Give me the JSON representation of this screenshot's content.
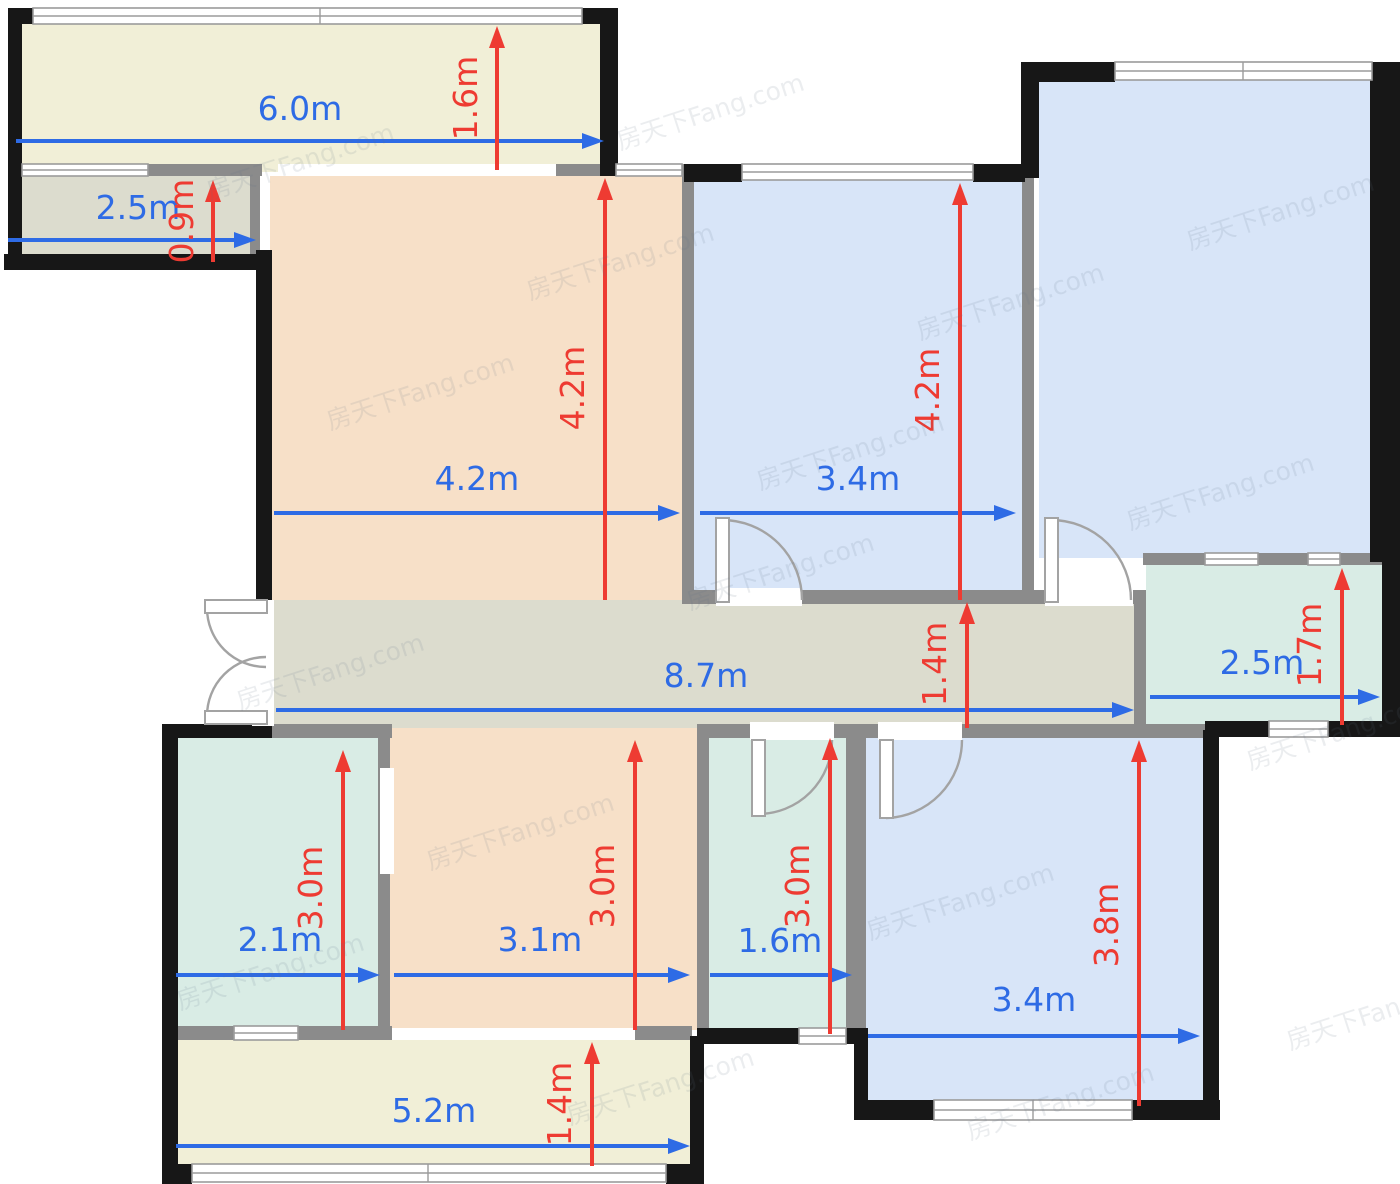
{
  "meta": {
    "watermark_text": "房天下Fang.com"
  },
  "palette": {
    "wall_black": "#171717",
    "wall_gray": "#8b8b8b",
    "window_stroke": "#9b9b9b",
    "door_stroke": "#a3a3a3",
    "cream": "#f1efd7",
    "graybeige": "#dcdcce",
    "peach": "#f7e0c8",
    "blue": "#d8e5f8",
    "teal": "#d9ece5",
    "dim_blue": "#2e6be5",
    "dim_red": "#ee3b32",
    "white": "#ffffff"
  },
  "rooms": [
    {
      "name": "balcony-top",
      "x": 20,
      "y": 22,
      "w": 584,
      "h": 150,
      "fill": "cream"
    },
    {
      "name": "storage",
      "x": 18,
      "y": 174,
      "w": 236,
      "h": 84,
      "fill": "graybeige"
    },
    {
      "name": "living-room",
      "x": 270,
      "y": 176,
      "w": 416,
      "h": 426,
      "fill": "peach"
    },
    {
      "name": "bedroom-middle",
      "x": 692,
      "y": 180,
      "w": 334,
      "h": 420,
      "fill": "blue"
    },
    {
      "name": "bedroom-large",
      "x": 1039,
      "y": 80,
      "w": 333,
      "h": 478,
      "fill": "blue"
    },
    {
      "name": "bathroom-right",
      "x": 1146,
      "y": 563,
      "w": 236,
      "h": 162,
      "fill": "teal"
    },
    {
      "name": "hallway",
      "x": 272,
      "y": 600,
      "w": 868,
      "h": 128,
      "fill": "graybeige"
    },
    {
      "name": "kitchen",
      "x": 176,
      "y": 738,
      "w": 206,
      "h": 292,
      "fill": "teal"
    },
    {
      "name": "dining",
      "x": 390,
      "y": 728,
      "w": 308,
      "h": 302,
      "fill": "peach"
    },
    {
      "name": "bathroom-middle",
      "x": 707,
      "y": 738,
      "w": 143,
      "h": 294,
      "fill": "teal"
    },
    {
      "name": "bedroom-bottom",
      "x": 866,
      "y": 738,
      "w": 339,
      "h": 368,
      "fill": "blue"
    },
    {
      "name": "balcony-bottom",
      "x": 176,
      "y": 1038,
      "w": 516,
      "h": 130,
      "fill": "cream"
    }
  ],
  "walls_black": [
    [
      8,
      8,
      14,
      262
    ],
    [
      8,
      8,
      32,
      16
    ],
    [
      582,
      8,
      36,
      16
    ],
    [
      600,
      10,
      18,
      166
    ],
    [
      4,
      254,
      268,
      16
    ],
    [
      256,
      250,
      16,
      352
    ],
    [
      162,
      724,
      110,
      14
    ],
    [
      162,
      724,
      16,
      460
    ],
    [
      162,
      1164,
      30,
      20
    ],
    [
      666,
      1164,
      38,
      20
    ],
    [
      690,
      1036,
      14,
      148
    ],
    [
      697,
      1028,
      102,
      16
    ],
    [
      846,
      1028,
      22,
      16
    ],
    [
      854,
      1036,
      14,
      78
    ],
    [
      854,
      1100,
      84,
      20
    ],
    [
      1132,
      1100,
      88,
      20
    ],
    [
      1203,
      730,
      16,
      390
    ],
    [
      1205,
      721,
      64,
      16
    ],
    [
      1328,
      721,
      72,
      16
    ],
    [
      1382,
      555,
      18,
      182
    ],
    [
      1370,
      62,
      30,
      500
    ],
    [
      1021,
      62,
      94,
      20
    ],
    [
      1021,
      62,
      18,
      116
    ],
    [
      684,
      164,
      58,
      18
    ],
    [
      973,
      164,
      52,
      18
    ]
  ],
  "walls_gray": [
    [
      250,
      174,
      10,
      84
    ],
    [
      148,
      164,
      114,
      12
    ],
    [
      554,
      164,
      50,
      12
    ],
    [
      682,
      164,
      12,
      438
    ],
    [
      1022,
      176,
      12,
      428
    ],
    [
      682,
      590,
      344,
      14
    ],
    [
      1034,
      590,
      112,
      14
    ],
    [
      1134,
      590,
      12,
      142
    ],
    [
      1143,
      553,
      239,
      12
    ],
    [
      270,
      724,
      122,
      14
    ],
    [
      697,
      724,
      162,
      14
    ],
    [
      848,
      724,
      362,
      14
    ],
    [
      378,
      724,
      12,
      310
    ],
    [
      846,
      724,
      20,
      316
    ],
    [
      697,
      724,
      12,
      318
    ],
    [
      176,
      1026,
      58,
      14
    ],
    [
      298,
      1026,
      94,
      14
    ],
    [
      635,
      1026,
      57,
      14
    ]
  ],
  "openings": [
    [
      278,
      164,
      278,
      12
    ],
    [
      252,
      600,
      22,
      126
    ],
    [
      380,
      768,
      14,
      106
    ],
    [
      716,
      588,
      86,
      18
    ],
    [
      1045,
      588,
      88,
      18
    ],
    [
      878,
      722,
      84,
      18
    ],
    [
      750,
      722,
      84,
      18
    ],
    [
      392,
      1028,
      243,
      12
    ]
  ],
  "windows": [
    {
      "x": 33,
      "y": 8,
      "w": 549,
      "h": 16,
      "div": [
        320
      ]
    },
    {
      "x": 22,
      "y": 164,
      "w": 126,
      "h": 12,
      "div": []
    },
    {
      "x": 616,
      "y": 164,
      "w": 66,
      "h": 12,
      "div": []
    },
    {
      "x": 742,
      "y": 164,
      "w": 231,
      "h": 16,
      "div": []
    },
    {
      "x": 1115,
      "y": 62,
      "w": 257,
      "h": 18,
      "div": [
        1243
      ]
    },
    {
      "x": 1205,
      "y": 553,
      "w": 53,
      "h": 12,
      "div": []
    },
    {
      "x": 1308,
      "y": 553,
      "w": 32,
      "h": 12,
      "div": []
    },
    {
      "x": 1269,
      "y": 721,
      "w": 59,
      "h": 16,
      "div": []
    },
    {
      "x": 934,
      "y": 1100,
      "w": 198,
      "h": 20,
      "div": [
        1033
      ]
    },
    {
      "x": 799,
      "y": 1028,
      "w": 47,
      "h": 16,
      "div": []
    },
    {
      "x": 234,
      "y": 1026,
      "w": 64,
      "h": 14,
      "div": []
    },
    {
      "x": 192,
      "y": 1164,
      "w": 474,
      "h": 18,
      "div": [
        428
      ]
    }
  ],
  "doors": [
    {
      "name": "door-bedroom-middle",
      "leaf": [
        716,
        518,
        13,
        84
      ],
      "arc": "M 722 520 A 80 80 0 0 1 802 600"
    },
    {
      "name": "door-bedroom-large",
      "leaf": [
        1045,
        518,
        13,
        84
      ],
      "arc": "M 1051 520 A 80 80 0 0 1 1131 600"
    },
    {
      "name": "door-bedroom-bottom",
      "leaf": [
        880,
        740,
        13,
        78
      ],
      "arc": "M 886 818 A 78 78 0 0 0 962 740"
    },
    {
      "name": "door-bathroom-middle",
      "leaf": [
        752,
        740,
        13,
        76
      ],
      "arc": "M 758 814 A 74 74 0 0 0 832 740"
    },
    {
      "name": "entry-door-upper",
      "leaf": [
        205,
        600,
        62,
        13
      ],
      "arc": "M 207 608 A 59 59 0 0 0 266 667"
    },
    {
      "name": "entry-door-lower",
      "leaf": [
        205,
        711,
        62,
        13
      ],
      "arc": "M 207 716 A 59 59 0 0 1 266 657"
    }
  ],
  "dims_h": [
    {
      "label": "6.0m",
      "x1": 16,
      "x2": 604,
      "y": 141,
      "lx": 300,
      "ly": 120
    },
    {
      "label": "2.5m",
      "x1": 8,
      "x2": 256,
      "y": 240,
      "lx": 138,
      "ly": 219
    },
    {
      "label": "4.2m",
      "x1": 274,
      "x2": 680,
      "y": 513,
      "lx": 477,
      "ly": 490
    },
    {
      "label": "3.4m",
      "x1": 700,
      "x2": 1016,
      "y": 513,
      "lx": 858,
      "ly": 490
    },
    {
      "label": "8.7m",
      "x1": 276,
      "x2": 1134,
      "y": 710,
      "lx": 706,
      "ly": 687
    },
    {
      "label": "2.5m",
      "x1": 1150,
      "x2": 1380,
      "y": 697,
      "lx": 1262,
      "ly": 674
    },
    {
      "label": "2.1m",
      "x1": 176,
      "x2": 380,
      "y": 975,
      "lx": 280,
      "ly": 951
    },
    {
      "label": "3.1m",
      "x1": 394,
      "x2": 690,
      "y": 975,
      "lx": 540,
      "ly": 951
    },
    {
      "label": "1.6m",
      "x1": 710,
      "x2": 852,
      "y": 975,
      "lx": 780,
      "ly": 952
    },
    {
      "label": "3.4m",
      "x1": 868,
      "x2": 1200,
      "y": 1036,
      "lx": 1034,
      "ly": 1011
    },
    {
      "label": "5.2m",
      "x1": 176,
      "x2": 690,
      "y": 1146,
      "lx": 434,
      "ly": 1122
    }
  ],
  "dims_v": [
    {
      "label": "1.6m",
      "x": 497,
      "y1": 26,
      "y2": 170,
      "lx": 477,
      "ly": 98
    },
    {
      "label": "0.9m",
      "x": 213,
      "y1": 180,
      "y2": 262,
      "lx": 193,
      "ly": 221
    },
    {
      "label": "4.2m",
      "x": 605,
      "y1": 178,
      "y2": 600,
      "lx": 584,
      "ly": 388
    },
    {
      "label": "4.2m",
      "x": 960,
      "y1": 183,
      "y2": 600,
      "lx": 939,
      "ly": 390
    },
    {
      "label": "1.4m",
      "x": 967,
      "y1": 602,
      "y2": 728,
      "lx": 946,
      "ly": 664
    },
    {
      "label": "1.7m",
      "x": 1342,
      "y1": 568,
      "y2": 725,
      "lx": 1321,
      "ly": 645
    },
    {
      "label": "3.0m",
      "x": 343,
      "y1": 750,
      "y2": 1030,
      "lx": 322,
      "ly": 888
    },
    {
      "label": "3.0m",
      "x": 635,
      "y1": 740,
      "y2": 1030,
      "lx": 614,
      "ly": 886
    },
    {
      "label": "3.0m",
      "x": 830,
      "y1": 738,
      "y2": 1034,
      "lx": 809,
      "ly": 886
    },
    {
      "label": "3.8m",
      "x": 1139,
      "y1": 740,
      "y2": 1106,
      "lx": 1118,
      "ly": 925
    },
    {
      "label": "1.4m",
      "x": 592,
      "y1": 1042,
      "y2": 1166,
      "lx": 571,
      "ly": 1104
    }
  ],
  "watermarks": [
    [
      210,
      200
    ],
    [
      620,
      150
    ],
    [
      1190,
      250
    ],
    [
      330,
      430
    ],
    [
      760,
      490
    ],
    [
      1130,
      530
    ],
    [
      240,
      710
    ],
    [
      690,
      610
    ],
    [
      1250,
      770
    ],
    [
      430,
      870
    ],
    [
      870,
      940
    ],
    [
      1290,
      1050
    ],
    [
      180,
      1010
    ],
    [
      570,
      1125
    ],
    [
      970,
      1140
    ],
    [
      530,
      300
    ],
    [
      920,
      340
    ]
  ]
}
